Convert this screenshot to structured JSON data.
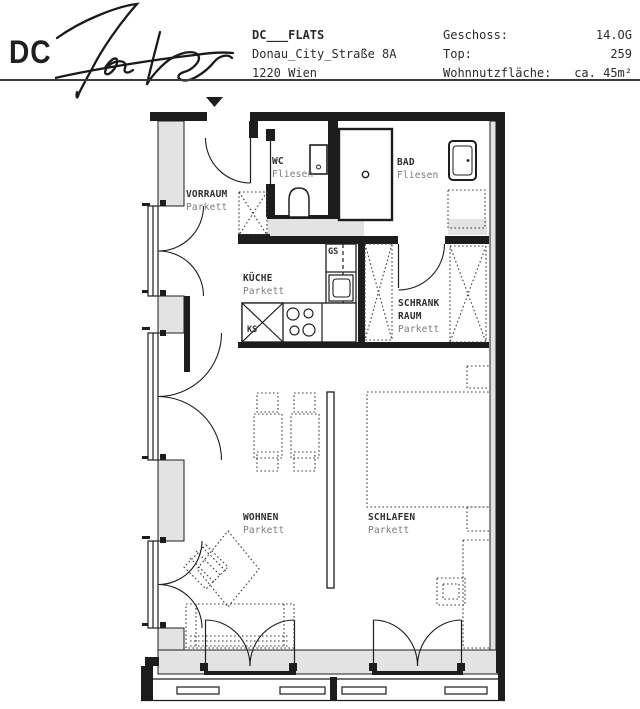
{
  "header": {
    "logo": "DC",
    "signature": "Flats",
    "project_name": "DC___FLATS",
    "address_line": "Donau_City_Straße 8A",
    "city_line": "1220 Wien",
    "info": [
      {
        "label": "Geschoss:",
        "value": "14.OG"
      },
      {
        "label": "Top:",
        "value": "259"
      },
      {
        "label": "Wohnnutzfläche:",
        "value": "ca. 45m²"
      }
    ]
  },
  "plan": {
    "rooms": {
      "vorraum": {
        "name": "VORRAUM",
        "floor": "Parkett"
      },
      "wc": {
        "name": "WC",
        "floor": "Fliesen"
      },
      "bad": {
        "name": "BAD",
        "floor": "Fliesen"
      },
      "kueche": {
        "name": "KÜCHE",
        "floor": "Parkett"
      },
      "schrankraum": {
        "name_line1": "SCHRANK",
        "name_line2": "RAUM",
        "floor": "Parkett"
      },
      "wohnen": {
        "name": "WOHNEN",
        "floor": "Parkett"
      },
      "schlafen": {
        "name": "SCHLAFEN",
        "floor": "Parkett"
      }
    },
    "appliances": {
      "dishwasher": "GS",
      "refrigerator": "KS"
    },
    "icons": {
      "entrance_marker": "down-triangle"
    },
    "colors": {
      "wall": "#1d1d1d",
      "wall_poche": "#e3e3e3",
      "room_label": "#2e2e2e",
      "material_label": "#7b7b7b"
    }
  }
}
